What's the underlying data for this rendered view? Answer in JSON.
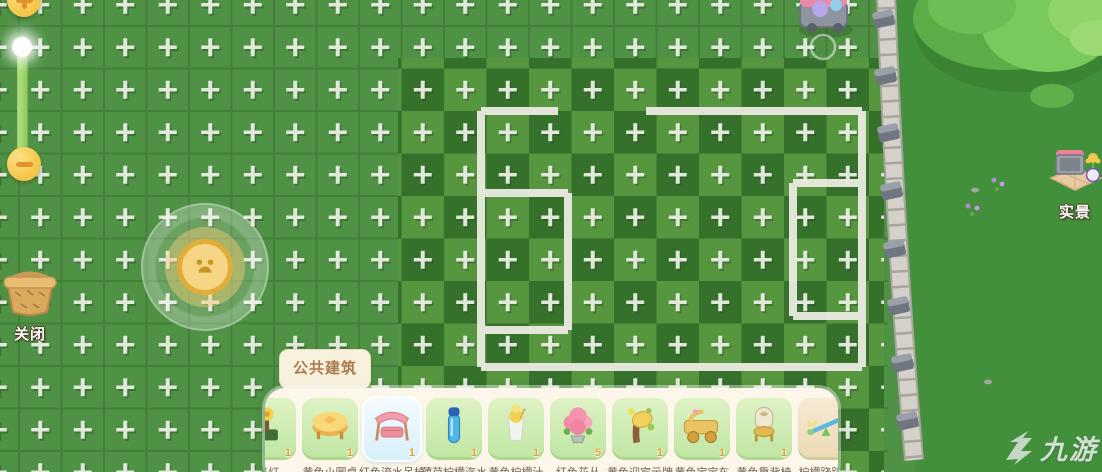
{
  "hud": {
    "zoom_in": {
      "icon": "plus"
    },
    "zoom_out": {
      "icon": "minus"
    },
    "close": {
      "label": "关闭"
    },
    "live_view": {
      "label": "实景"
    }
  },
  "build_panel": {
    "tab_label": "公共建筑",
    "items": [
      {
        "name": "路灯",
        "price": "1",
        "icon": "flower-lamp",
        "variant": "green",
        "selected": false
      },
      {
        "name": "黄色小圆桌",
        "price": "1",
        "icon": "round-table",
        "variant": "green",
        "selected": false
      },
      {
        "name": "红色流水吊椅",
        "price": "1",
        "icon": "swing-chair",
        "variant": "green",
        "selected": true
      },
      {
        "name": "薄荷柠檬汽水",
        "price": "1",
        "icon": "blue-bottle",
        "variant": "green",
        "selected": false
      },
      {
        "name": "黄色柠檬汁",
        "price": "1",
        "icon": "lemonade",
        "variant": "green",
        "selected": false
      },
      {
        "name": "红色花丛",
        "price": "5",
        "icon": "flower-bush",
        "variant": "green",
        "selected": false
      },
      {
        "name": "黄色迎宾示牌",
        "price": "1",
        "icon": "welcome-sign",
        "variant": "green",
        "selected": false
      },
      {
        "name": "黄色宝宝车",
        "price": "1",
        "icon": "baby-carriage",
        "variant": "green",
        "selected": false
      },
      {
        "name": "黄色靠背椅",
        "price": "1",
        "icon": "royal-chair",
        "variant": "green",
        "selected": false
      },
      {
        "name": "柠檬跷跷板",
        "price": "",
        "icon": "seesaw",
        "variant": "tan",
        "selected": false
      }
    ]
  },
  "watermark": {
    "text": "九游"
  },
  "colors": {
    "field_green": "#4f9145",
    "mowed_dark": "#346f2a",
    "mowed_mid": "#55963f",
    "path_white": "#e9eadf",
    "panel_bg": "#fcf7ea",
    "card_green": "#cfeab0",
    "accent_gold": "#f2c94d",
    "tab_text": "#ad7a4e"
  }
}
